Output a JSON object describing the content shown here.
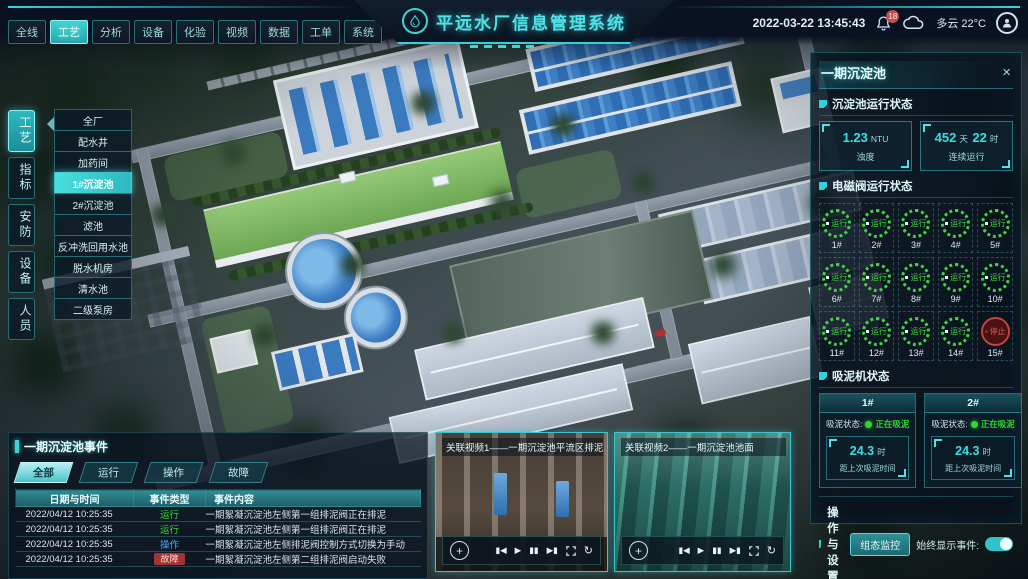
{
  "colors": {
    "accent": "#38d8de",
    "run_green": "#38d438",
    "fault_red": "#d64545",
    "op_blue": "#4da6ff",
    "active_tab_bg": "#3fd3d6"
  },
  "top_bar": {
    "tabs": [
      "全线",
      "工艺",
      "分析",
      "设备",
      "化验",
      "视频",
      "数据",
      "工单",
      "系统"
    ],
    "active_tab": "工艺",
    "title": "平远水厂信息管理系统",
    "datetime": "2022-03-22 13:45:43",
    "notification_count": "18",
    "weather": "多云 22°C"
  },
  "left_nav": {
    "tabs": [
      "工艺",
      "指标",
      "安防",
      "设备",
      "人员"
    ],
    "active": "工艺"
  },
  "left_menu": {
    "items": [
      "全厂",
      "配水井",
      "加药间",
      "1#沉淀池",
      "2#沉淀池",
      "滤池",
      "反冲洗回用水池",
      "脱水机房",
      "清水池",
      "二级泵房"
    ],
    "active": "1#沉淀池"
  },
  "right_panel": {
    "title": "一期沉淀池",
    "close": "×",
    "run_status": {
      "title": "沉淀池运行状态",
      "turbidity": {
        "value": "1.23",
        "unit": "NTU",
        "label": "浊度"
      },
      "uptime": {
        "v1": "452",
        "u1": "天",
        "v2": "22",
        "u2": "时",
        "label": "连续运行"
      }
    },
    "valves": {
      "title": "电磁阀运行状态",
      "items": [
        {
          "id": "1#",
          "status": "运行"
        },
        {
          "id": "2#",
          "status": "运行"
        },
        {
          "id": "3#",
          "status": "运行"
        },
        {
          "id": "4#",
          "status": "运行"
        },
        {
          "id": "5#",
          "status": "运行"
        },
        {
          "id": "6#",
          "status": "运行"
        },
        {
          "id": "7#",
          "status": "运行"
        },
        {
          "id": "8#",
          "status": "运行"
        },
        {
          "id": "9#",
          "status": "运行"
        },
        {
          "id": "10#",
          "status": "运行"
        },
        {
          "id": "11#",
          "status": "运行"
        },
        {
          "id": "12#",
          "status": "运行"
        },
        {
          "id": "13#",
          "status": "运行"
        },
        {
          "id": "14#",
          "status": "运行"
        },
        {
          "id": "15#",
          "status": "停止"
        }
      ]
    },
    "scrapers": {
      "title": "吸泥机状态",
      "status_label": "吸泥状态:",
      "items": [
        {
          "id": "1#",
          "status": "正在吸泥",
          "value": "24.3",
          "unit": "时",
          "caption": "距上次吸泥时间"
        },
        {
          "id": "2#",
          "status": "正在吸泥",
          "value": "24.3",
          "unit": "时",
          "caption": "距上次吸泥时间"
        }
      ]
    },
    "settings": {
      "title": "操作与设置",
      "button": "组态监控",
      "toggle_label": "始终显示事件:",
      "toggle_on": true
    }
  },
  "events_panel": {
    "title": "一期沉淀池事件",
    "filters": [
      "全部",
      "运行",
      "操作",
      "故障"
    ],
    "active_filter": "全部",
    "columns": [
      "日期与时间",
      "事件类型",
      "事件内容"
    ],
    "rows": [
      {
        "time": "2022/04/12 10:25:35",
        "type": "运行",
        "content": "一期絮凝沉淀池左侧第一组排泥阀正在排泥"
      },
      {
        "time": "2022/04/12 10:25:35",
        "type": "运行",
        "content": "一期絮凝沉淀池左侧第一组排泥阀正在排泥"
      },
      {
        "time": "2022/04/12 10:25:35",
        "type": "操作",
        "content": "一期絮凝沉淀池左侧排泥阀控制方式切换为手动"
      },
      {
        "time": "2022/04/12 10:25:35",
        "type": "故障",
        "content": "一期絮凝沉淀池左侧第二组排泥阀启动失败"
      }
    ]
  },
  "videos": {
    "items": [
      {
        "title": "关联视频1——一期沉淀池平流区排泥管廊"
      },
      {
        "title": "关联视频2——一期沉淀池池面"
      }
    ],
    "controls": {
      "ptz": "+",
      "prev": "▮◀",
      "play": "▶",
      "pause": "▮▮",
      "next": "▶▮",
      "loop": "↻"
    }
  }
}
